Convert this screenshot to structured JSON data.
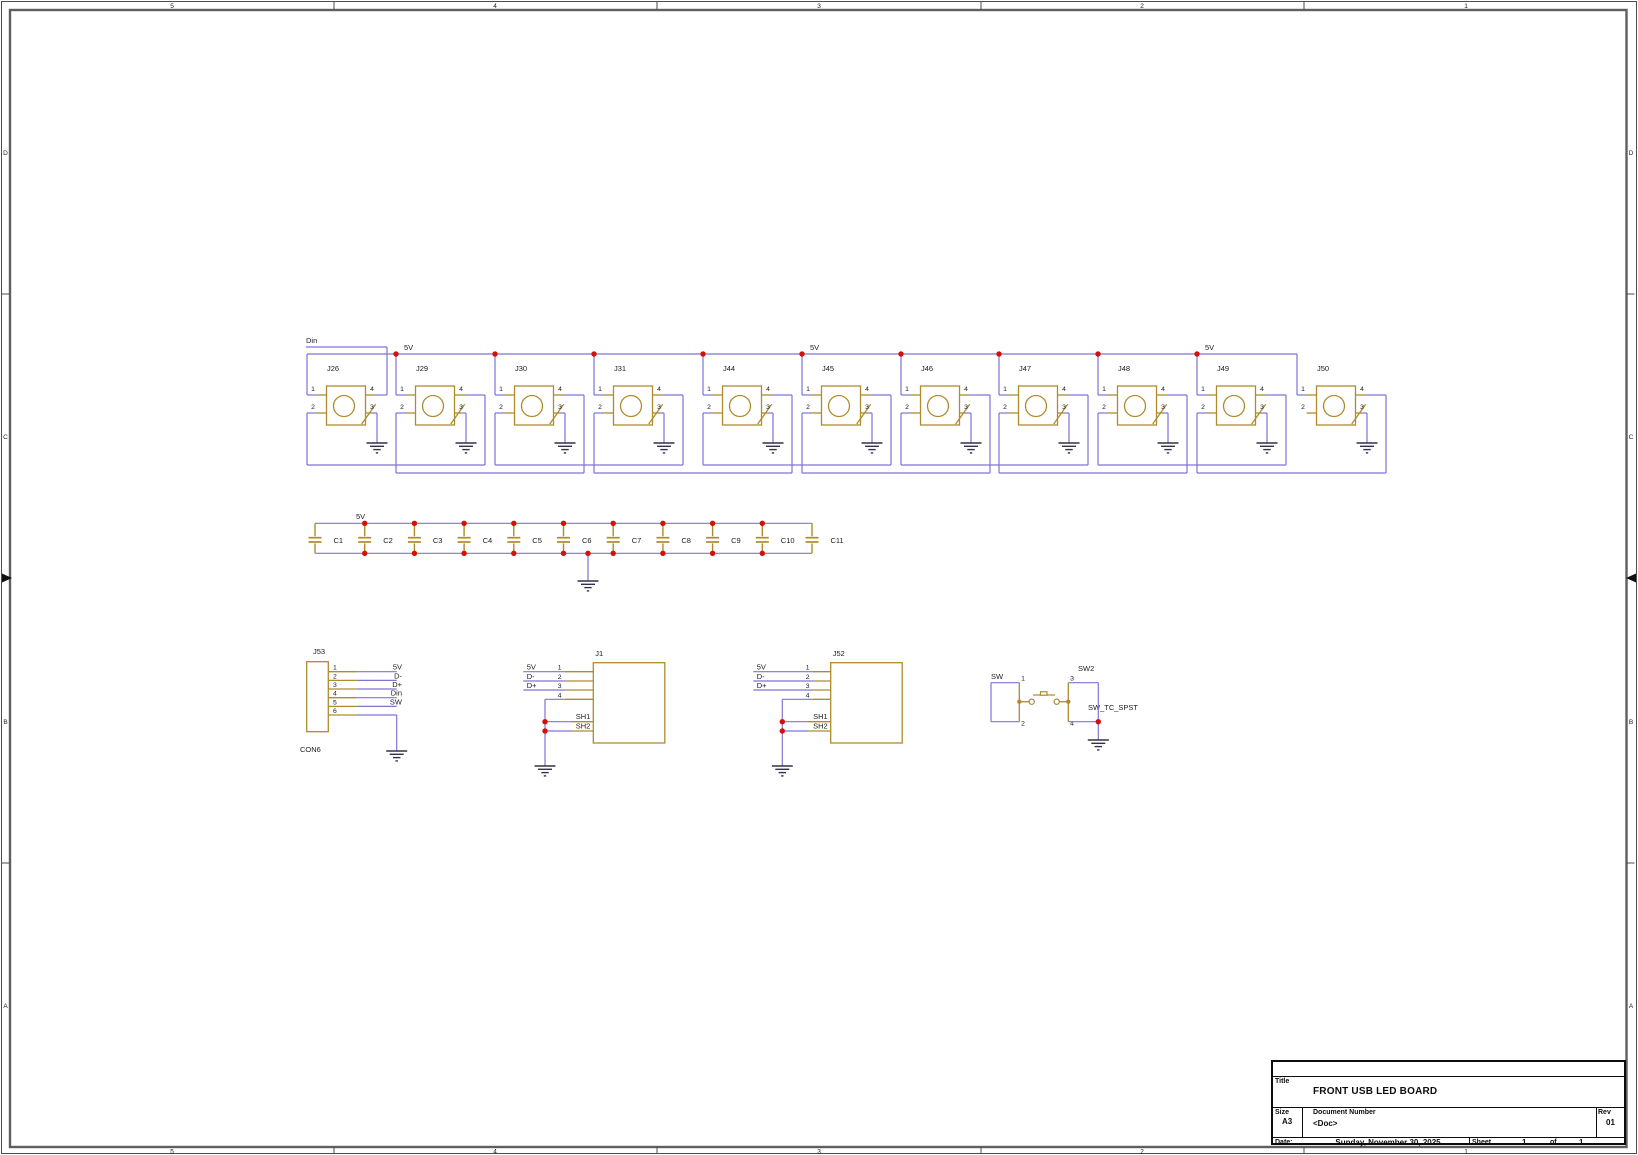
{
  "colors": {
    "wire": "#8073d6",
    "part": "#ae8c2d",
    "junction": "#d40f0f",
    "text": "#1b1b1b",
    "ground": "#32324a",
    "border": "#5f5f5f",
    "background": "#ffffff"
  },
  "border": {
    "top_zones": [
      "5",
      "4",
      "3",
      "2",
      "1"
    ],
    "side_zones": [
      "D",
      "C",
      "B",
      "A"
    ]
  },
  "led_row": {
    "input_net": "Din",
    "power_net": "5V",
    "pin_numbers": [
      "1",
      "2",
      "3",
      "4"
    ],
    "refs": [
      "J26",
      "J29",
      "J30",
      "J31",
      "J44",
      "J45",
      "J46",
      "J47",
      "J48",
      "J49",
      "J50"
    ]
  },
  "cap_row": {
    "power_net": "5V",
    "refs": [
      "C1",
      "C2",
      "C3",
      "C4",
      "C5",
      "C6",
      "C7",
      "C8",
      "C9",
      "C10",
      "C11"
    ]
  },
  "connectors": {
    "j53": {
      "ref": "J53",
      "value": "CON6",
      "pin_numbers": [
        "1",
        "2",
        "3",
        "4",
        "5",
        "6"
      ],
      "net_labels": [
        "5V",
        "D-",
        "D+",
        "Din",
        "SW"
      ]
    },
    "j1": {
      "ref": "J1",
      "pin_numbers": [
        "1",
        "2",
        "3",
        "4"
      ],
      "net_labels": [
        "5V",
        "D-",
        "D+"
      ],
      "shield_labels": [
        "SH1",
        "SH2"
      ]
    },
    "j52": {
      "ref": "J52",
      "pin_numbers": [
        "1",
        "2",
        "3",
        "4"
      ],
      "net_labels": [
        "5V",
        "D-",
        "D+"
      ],
      "shield_labels": [
        "SH1",
        "SH2"
      ]
    },
    "sw2": {
      "ref": "SW2",
      "value": "SW_TC_SPST",
      "net_label": "SW",
      "pin_numbers": [
        "1",
        "2",
        "3",
        "4"
      ]
    }
  },
  "title_block": {
    "title_label": "Title",
    "title": "FRONT USB LED BOARD",
    "size_label": "Size",
    "size": "A3",
    "doc_label": "Document Number",
    "doc": "<Doc>",
    "rev_label": "Rev",
    "rev": "01",
    "date_label": "Date:",
    "date": "Sunday, November 30, 2025",
    "sheet_label": "Sheet",
    "sheet_number": "1",
    "of_label": "of",
    "sheet_total": "1"
  }
}
